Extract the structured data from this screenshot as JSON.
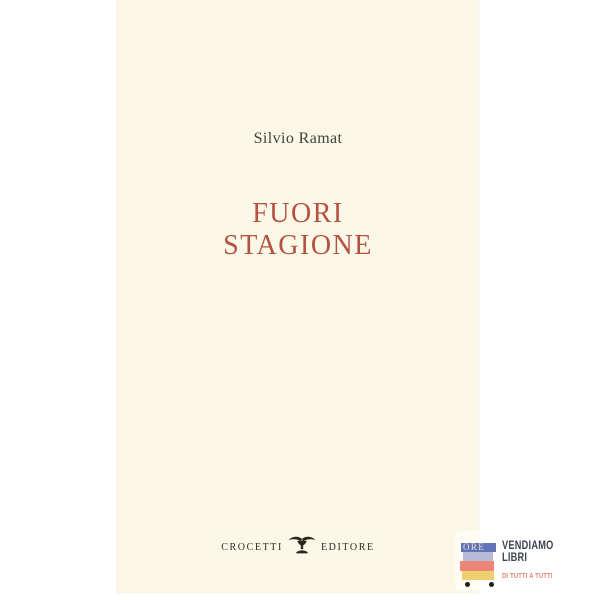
{
  "cover": {
    "background": "#fcf8e7",
    "author": "Silvio Ramat",
    "title": [
      "FUORI",
      "STAGIONE"
    ],
    "title_color": "#b55243",
    "publisher": {
      "left": "CROCETTI",
      "right": "EDITORE",
      "logo": "winged-cup-icon",
      "text_color": "#2f2a24"
    }
  },
  "badge": {
    "line1": "VENDIAMO",
    "line2": "LIBRI",
    "tagline": "DI TUTTI A TUTTI",
    "ghost_text": "ORE",
    "icon": "book-cart-icon",
    "colors": {
      "text": "#3d4352",
      "tagline": "#e07f6c",
      "book_blue": "#6273b7",
      "book_lavender": "#b9b9d8",
      "book_salmon": "#ec8678",
      "book_yellow": "#eed06f",
      "wheels": "#1d1d1b"
    }
  }
}
